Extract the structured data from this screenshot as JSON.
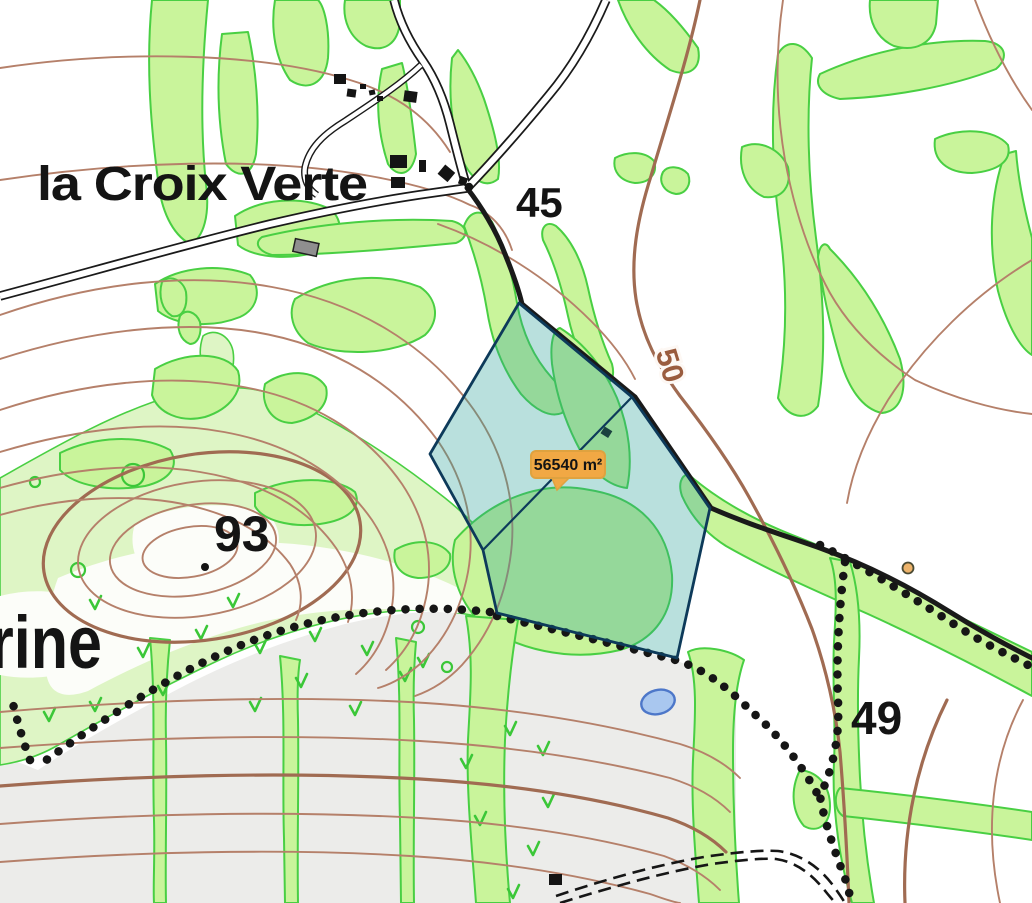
{
  "map": {
    "description": "Topographic map extract with parcel area measurement overlay",
    "labels": {
      "place_main": "la Croix Verte",
      "place_partial_left": "rine",
      "elevation_45": "45",
      "elevation_93": "93",
      "elevation_49": "49",
      "contour_50": "50"
    },
    "measurement": {
      "area_label": "56540 m²"
    },
    "icons": {
      "poi_marker": "orange-dot-marker",
      "spot_height": "black-dot",
      "pond": "blue-pond"
    },
    "colors": {
      "parcel_fill": "#2aa198",
      "parcel_stroke": "#0d3a5a",
      "tooltip_bg": "#f1a844",
      "tooltip_border": "#dfa23f",
      "contour": "#b5806a",
      "contour_index": "#a06b52",
      "vegetation_fill": "#c9f49b",
      "vegetation_border": "#49cf43",
      "meadow_fill": "#def5c5",
      "field_gray": "#ececea",
      "pond_fill": "#a9c7ef",
      "pond_stroke": "#4d77c9",
      "road_color": "#1a1a1a",
      "label_color": "#141414",
      "contour_label_color": "#9a5c3e",
      "marker_fill": "#edb36b"
    }
  }
}
